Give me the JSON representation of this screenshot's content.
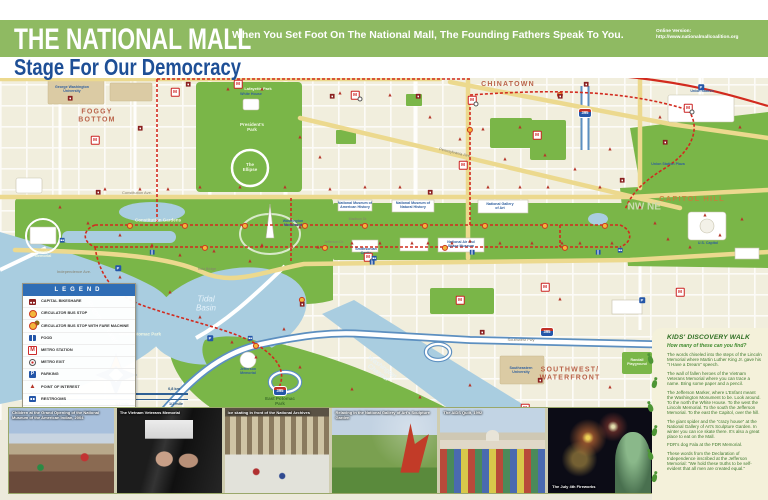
{
  "header": {
    "title": "THE NATIONAL MALL",
    "subtitle": "Stage For Our Democracy",
    "tagline": "When You Set Foot On The National Mall, The Founding Fathers Speak To You.",
    "online_label": "Online Version:",
    "online_url": "http://www.nationalmallcoalition.org",
    "banner_color": "#8fba62",
    "subtitle_color": "#1e4f96"
  },
  "map": {
    "colors": {
      "land": "#f1eedd",
      "park": "#7ab648",
      "water": "#a9cde0",
      "route": "#d22a1e",
      "avenue": "#ecd98e",
      "freeway": "#5c8fc0"
    },
    "labels": [
      {
        "t": "FOGGY\nBOTTOM",
        "x": 97,
        "y": 116,
        "c": "area"
      },
      {
        "t": "CHINATOWN",
        "x": 508,
        "y": 85,
        "c": "area"
      },
      {
        "t": "CAPITOL HILL",
        "x": 692,
        "y": 199,
        "c": "area",
        "s": 7.5,
        "col": "#c87f3a"
      },
      {
        "t": "SOUTHWEST/\nWATERFRONT",
        "x": 570,
        "y": 374,
        "c": "area"
      },
      {
        "t": "Tidal\nBasin",
        "x": 206,
        "y": 304,
        "c": "water",
        "s": 8
      },
      {
        "t": "Potomac River",
        "x": 102,
        "y": 322,
        "c": "water",
        "r": 55
      },
      {
        "t": "Washington\nChannel",
        "x": 380,
        "y": 370,
        "c": "water",
        "s": 6.5,
        "r": 37
      },
      {
        "t": "West Potomac Park",
        "x": 140,
        "y": 335,
        "c": "park"
      },
      {
        "t": "East Potomac\nPark",
        "x": 280,
        "y": 402,
        "c": "dkg"
      },
      {
        "t": "Constitution Gardens",
        "x": 158,
        "y": 221,
        "c": "park"
      },
      {
        "t": "President's\nPark",
        "x": 252,
        "y": 128,
        "c": "park"
      },
      {
        "t": "Lafayette Park",
        "x": 258,
        "y": 89,
        "c": "park",
        "s": 4
      },
      {
        "t": "The\nEllipse",
        "x": 250,
        "y": 168,
        "c": "park"
      },
      {
        "t": "Union Station Plaza",
        "x": 668,
        "y": 165,
        "c": "lm"
      },
      {
        "t": "Randall\nPlayground",
        "x": 637,
        "y": 363,
        "c": "park",
        "s": 3.6
      },
      {
        "t": "Constitution Ave.",
        "x": 137,
        "y": 193,
        "c": "street"
      },
      {
        "t": "Independence Ave.",
        "x": 74,
        "y": 272,
        "c": "street"
      },
      {
        "t": "Madison Dr.",
        "x": 358,
        "y": 220,
        "c": "street",
        "s": 3.5
      },
      {
        "t": "Jefferson Dr.",
        "x": 334,
        "y": 243,
        "c": "street",
        "s": 3.5
      },
      {
        "t": "Pennsylvania Ave.",
        "x": 455,
        "y": 153,
        "c": "street",
        "r": 13
      },
      {
        "t": "Southwest Fwy",
        "x": 521,
        "y": 340,
        "c": "street"
      },
      {
        "t": "Kutz Bridge",
        "x": 207,
        "y": 270,
        "c": "street",
        "s": 3.5
      },
      {
        "t": "George Washington\nUniversity",
        "x": 72,
        "y": 90,
        "c": "lm"
      },
      {
        "t": "Union Station",
        "x": 702,
        "y": 92,
        "c": "lm"
      },
      {
        "t": "National Gallery\nof Art",
        "x": 500,
        "y": 207,
        "c": "lm"
      },
      {
        "t": "National Museum of\nNatural History",
        "x": 413,
        "y": 206,
        "c": "lm"
      },
      {
        "t": "National Museum of\nAmerican History",
        "x": 355,
        "y": 206,
        "c": "lm"
      },
      {
        "t": "National Air and\nSpace Museum",
        "x": 461,
        "y": 245,
        "c": "lm"
      },
      {
        "t": "Washington\nMonument",
        "x": 293,
        "y": 224,
        "c": "lm"
      },
      {
        "t": "Lincoln\nMemorial",
        "x": 43,
        "y": 254,
        "c": "park",
        "s": 3.8
      },
      {
        "t": "Jefferson\nMemorial",
        "x": 248,
        "y": 372,
        "c": "lm"
      },
      {
        "t": "White House",
        "x": 251,
        "y": 95,
        "c": "lm"
      },
      {
        "t": "Southeastern\nUniversity",
        "x": 521,
        "y": 371,
        "c": "lm"
      },
      {
        "t": "Smithsonian\nCastle",
        "x": 366,
        "y": 252,
        "c": "lm"
      },
      {
        "t": "U.S. Capitol",
        "x": 708,
        "y": 244,
        "c": "lm"
      },
      {
        "t": "NW",
        "x": 636,
        "y": 208,
        "c": "quad"
      },
      {
        "t": "NE",
        "x": 654,
        "y": 208,
        "c": "quad"
      }
    ],
    "poi_markers": [
      [
        60,
        208
      ],
      [
        88,
        224
      ],
      [
        105,
        190
      ],
      [
        120,
        236
      ],
      [
        140,
        190
      ],
      [
        152,
        246
      ],
      [
        168,
        190
      ],
      [
        180,
        256
      ],
      [
        200,
        188
      ],
      [
        214,
        252
      ],
      [
        240,
        188
      ],
      [
        250,
        262
      ],
      [
        262,
        246
      ],
      [
        285,
        188
      ],
      [
        300,
        228
      ],
      [
        318,
        248
      ],
      [
        330,
        190
      ],
      [
        352,
        244
      ],
      [
        365,
        188
      ],
      [
        380,
        244
      ],
      [
        400,
        188
      ],
      [
        412,
        244
      ],
      [
        428,
        244
      ],
      [
        452,
        244
      ],
      [
        470,
        242
      ],
      [
        488,
        188
      ],
      [
        500,
        244
      ],
      [
        520,
        188
      ],
      [
        532,
        244
      ],
      [
        548,
        188
      ],
      [
        562,
        244
      ],
      [
        580,
        244
      ],
      [
        600,
        188
      ],
      [
        612,
        244
      ],
      [
        640,
        208
      ],
      [
        655,
        224
      ],
      [
        668,
        240
      ],
      [
        690,
        248
      ],
      [
        705,
        216
      ],
      [
        720,
        236
      ],
      [
        742,
        220
      ],
      [
        120,
        278
      ],
      [
        170,
        293
      ],
      [
        200,
        318
      ],
      [
        232,
        343
      ],
      [
        256,
        358
      ],
      [
        284,
        330
      ],
      [
        300,
        368
      ],
      [
        352,
        390
      ],
      [
        420,
        398
      ],
      [
        470,
        386
      ],
      [
        560,
        300
      ],
      [
        610,
        388
      ],
      [
        228,
        90
      ],
      [
        262,
        90
      ],
      [
        300,
        138
      ],
      [
        320,
        158
      ],
      [
        430,
        118
      ],
      [
        460,
        140
      ],
      [
        520,
        128
      ],
      [
        545,
        156
      ],
      [
        575,
        170
      ],
      [
        610,
        150
      ],
      [
        660,
        118
      ],
      [
        740,
        128
      ],
      [
        390,
        96
      ],
      [
        340,
        94
      ],
      [
        505,
        160
      ],
      [
        483,
        130
      ]
    ],
    "metro_stations": [
      [
        95,
        140
      ],
      [
        175,
        92
      ],
      [
        238,
        84
      ],
      [
        355,
        95
      ],
      [
        472,
        100
      ],
      [
        537,
        135
      ],
      [
        688,
        108
      ],
      [
        463,
        165
      ],
      [
        368,
        257
      ],
      [
        460,
        300
      ],
      [
        545,
        287
      ],
      [
        680,
        292
      ],
      [
        525,
        408
      ]
    ],
    "metro_exits": [
      [
        360,
        99
      ],
      [
        476,
        104
      ],
      [
        692,
        112
      ],
      [
        372,
        261
      ]
    ],
    "circulator_stops": [
      [
        130,
        226
      ],
      [
        185,
        226
      ],
      [
        245,
        226
      ],
      [
        305,
        226
      ],
      [
        365,
        226
      ],
      [
        425,
        226
      ],
      [
        485,
        226
      ],
      [
        545,
        226
      ],
      [
        605,
        226
      ],
      [
        205,
        248
      ],
      [
        325,
        248
      ],
      [
        445,
        248
      ],
      [
        565,
        248
      ],
      [
        470,
        130
      ],
      [
        560,
        95
      ],
      [
        302,
        300
      ],
      [
        256,
        346
      ]
    ],
    "bikeshare": [
      [
        70,
        98
      ],
      [
        140,
        128
      ],
      [
        188,
        84
      ],
      [
        332,
        96
      ],
      [
        430,
        192
      ],
      [
        560,
        96
      ],
      [
        622,
        180
      ],
      [
        302,
        304
      ],
      [
        482,
        332
      ],
      [
        665,
        142
      ],
      [
        418,
        96
      ],
      [
        98,
        192
      ],
      [
        540,
        380
      ],
      [
        586,
        84
      ]
    ],
    "parking": [
      [
        701,
        87
      ],
      [
        118,
        268
      ],
      [
        210,
        338
      ],
      [
        545,
        418
      ],
      [
        642,
        300
      ]
    ],
    "food": [
      [
        152,
        252
      ],
      [
        372,
        262
      ],
      [
        472,
        252
      ],
      [
        598,
        252
      ]
    ],
    "restrooms": [
      [
        62,
        240
      ],
      [
        250,
        338
      ],
      [
        374,
        258
      ],
      [
        620,
        250
      ]
    ],
    "shields": [
      {
        "t": "395",
        "x": 585,
        "y": 113
      },
      {
        "t": "395",
        "x": 547,
        "y": 332
      },
      {
        "t": "395",
        "x": 280,
        "y": 391
      }
    ]
  },
  "legend": {
    "title": "LEGEND",
    "items": [
      {
        "label": "CAPITAL BIKESHARE",
        "icon": "bikeshare"
      },
      {
        "label": "CIRCULATOR BUS STOP",
        "icon": "circulator"
      },
      {
        "label": "CIRCULATOR BUS STOP WITH FARE MACHINE",
        "icon": "circulator-fare"
      },
      {
        "label": "FOOD",
        "icon": "food"
      },
      {
        "label": "METRO STATION",
        "icon": "metro"
      },
      {
        "label": "METRO EXIT",
        "icon": "metro-exit"
      },
      {
        "label": "PARKING",
        "icon": "parking"
      },
      {
        "label": "POINT OF INTEREST",
        "icon": "poi"
      },
      {
        "label": "RESTROOMS",
        "icon": "restrooms"
      },
      {
        "label": "CIRCULATOR NATIONAL MALL ROUTE",
        "icon": "route"
      }
    ]
  },
  "scale": {
    "zero_top": "0",
    "km_label": "0,8 km",
    "zero_bottom": "0",
    "quarter_mile": "1/4 mile",
    "half_mile": "1/2 mile"
  },
  "sidebar": {
    "title": "KIDS' DISCOVERY WALK",
    "subtitle": "How many of these can you find?",
    "paragraphs": [
      "The words chiseled into the steps of the Lincoln Memorial where Martin Luther King Jr. gave his \"I Have a Dream\" speech.",
      "The wall of fallen heroes of the Vietnam Veterans Memorial where you can trace a name. Bring some paper and a pencil.",
      "The Jefferson Marker, where L'Enfant meant the Washington Monument to be. Look around. To the north the White House. To the west the Lincoln Memorial. To the south the Jefferson Memorial. To the east the Capitol, over the hill.",
      "The giant spider and the \"crazy house\" at the National Gallery of Art's Sculpture Garden. In winter you can ice skate there. It's also a great place to eat on the Mall.",
      "FDR's dog Fala at the FDR Memorial.",
      "These words from the Declaration of Independence inscribed at the Jefferson Memorial: \"We hold these truths to be self-evident that all men are created equal.\""
    ]
  },
  "photos": [
    {
      "caption": "Children at the Grand Opening of the National Museum of the American Indian, 2004",
      "style": "crowd",
      "cap": "tl"
    },
    {
      "caption": "The Vietnam Veterans Memorial",
      "style": "wall",
      "cap": "tl"
    },
    {
      "caption": "Ice skating in front of the National Archives",
      "style": "rink",
      "cap": "tl"
    },
    {
      "caption": "Relaxing in the National Gallery of Art's Sculpture Garden",
      "style": "sculpture",
      "cap": "tl"
    },
    {
      "caption": "The AIDS Quilt, 1992",
      "style": "quilt",
      "cap": "tl"
    },
    {
      "caption": "The July 4th Fireworks",
      "style": "fireworks",
      "cap": "bl"
    }
  ]
}
